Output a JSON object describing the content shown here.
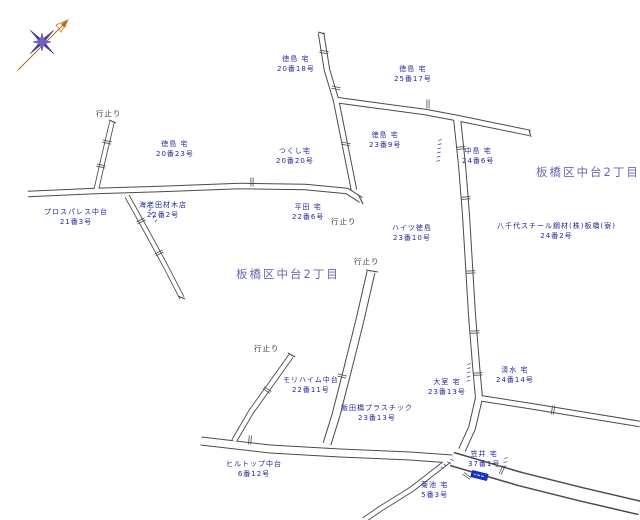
{
  "map": {
    "district_name": "板橋区中台2丁目",
    "colors": {
      "background": "#ffffff",
      "road_line": "#4a4a4a",
      "house_label": "#24249c",
      "area_label": "#6a6ab4",
      "deadend_label": "#3a3a3a",
      "sign_blue": "#1636c8",
      "compass_navy": "#3f3f9a",
      "compass_purple": "#7e5fc0",
      "compass_arrow": "#b5651d"
    },
    "labels": [
      {
        "type": "house",
        "x": 277,
        "y": 54,
        "lines": [
          "徳島 宅",
          "20番18号"
        ]
      },
      {
        "type": "house",
        "x": 394,
        "y": 64,
        "lines": [
          "徳島 宅",
          "25番17号"
        ]
      },
      {
        "type": "house",
        "x": 369,
        "y": 130,
        "lines": [
          "徳島 宅",
          "23番9号"
        ]
      },
      {
        "type": "house",
        "x": 462,
        "y": 146,
        "lines": [
          "中島 宅",
          "24番6号"
        ]
      },
      {
        "type": "dead",
        "x": 96,
        "y": 109,
        "lines": [
          "行止り"
        ]
      },
      {
        "type": "house",
        "x": 156,
        "y": 139,
        "lines": [
          "徳島 宅",
          "20番23号"
        ]
      },
      {
        "type": "house",
        "x": 276,
        "y": 146,
        "lines": [
          "つくし宅",
          "20番20号"
        ]
      },
      {
        "type": "area",
        "x": 536,
        "y": 167,
        "lines": [
          "板橋区中台2丁目"
        ]
      },
      {
        "type": "house",
        "x": 44,
        "y": 207,
        "lines": [
          "プロスパレス中台",
          "21番3号"
        ]
      },
      {
        "type": "house",
        "x": 139,
        "y": 200,
        "lines": [
          "海老田材木店",
          "22番2号"
        ]
      },
      {
        "type": "house",
        "x": 292,
        "y": 202,
        "lines": [
          "平田 宅",
          "22番6号"
        ]
      },
      {
        "type": "dead",
        "x": 331,
        "y": 217,
        "lines": [
          "行止り"
        ]
      },
      {
        "type": "house",
        "x": 392,
        "y": 223,
        "lines": [
          "ハイツ徳島",
          "23番10号"
        ]
      },
      {
        "type": "house",
        "x": 497,
        "y": 221,
        "lines": [
          "八千代スチール鋼材(株)板橋(寮)",
          "24番2号"
        ]
      },
      {
        "type": "area",
        "x": 236,
        "y": 269,
        "lines": [
          "板橋区中台2丁目"
        ]
      },
      {
        "type": "dead",
        "x": 354,
        "y": 257,
        "lines": [
          "行止り"
        ]
      },
      {
        "type": "dead",
        "x": 254,
        "y": 344,
        "lines": [
          "行止り"
        ]
      },
      {
        "type": "house",
        "x": 283,
        "y": 375,
        "lines": [
          "モリハイム中台",
          "22番11号"
        ]
      },
      {
        "type": "house",
        "x": 428,
        "y": 377,
        "lines": [
          "大室 宅",
          "23番13号"
        ]
      },
      {
        "type": "house",
        "x": 496,
        "y": 365,
        "lines": [
          "清水 宅",
          "24番14号"
        ]
      },
      {
        "type": "house",
        "x": 341,
        "y": 403,
        "lines": [
          "飯田橋プラスチック",
          "23番13号"
        ]
      },
      {
        "type": "house",
        "x": 226,
        "y": 459,
        "lines": [
          "ヒルトップ中台",
          "6番12号"
        ]
      },
      {
        "type": "house",
        "x": 468,
        "y": 449,
        "lines": [
          "笠井 宅",
          "37番1号"
        ]
      },
      {
        "type": "house",
        "x": 421,
        "y": 480,
        "lines": [
          "菊池 宅",
          "5番3号"
        ]
      }
    ],
    "roads": [
      {
        "id": "top-vertical",
        "d": "M321,33 L327,70 L336,100 L343,135 L350,170 L354,190",
        "w": 6.5,
        "f": 4.5
      },
      {
        "id": "top-east",
        "d": "M336,100 L380,106 L425,112 L457,118 L530,133",
        "w": 6.5,
        "f": 4.5
      },
      {
        "id": "right-vertical",
        "d": "M457,118 L462,165 L466,215 L469,265 L472,315 L476,365 L479,398 L472,428 L462,450",
        "w": 8,
        "f": 6
      },
      {
        "id": "mid-horizontal",
        "d": "M28,194 L95,191 L160,189 L240,186 L305,187 L347,191 L361,200",
        "w": 6.5,
        "f": 4.5
      },
      {
        "id": "deadend-upleft",
        "d": "M96,191 L103,160 L112,122",
        "w": 5.5,
        "f": 3.8
      },
      {
        "id": "branch-down-left",
        "d": "M127,196 L147,232 L166,267 L182,298",
        "w": 5.5,
        "f": 3.8
      },
      {
        "id": "center-deadend",
        "d": "M371,272 L360,320 L348,368 L336,415 L327,444",
        "w": 9,
        "f": 7
      },
      {
        "id": "left-deadend",
        "d": "M291,356 L271,384 L251,412 L234,441",
        "w": 6,
        "f": 4.2
      },
      {
        "id": "bottom-main",
        "d": "M201,441 L270,449 L340,453 L410,456 L452,459",
        "w": 9,
        "f": 7
      },
      {
        "id": "bottom-wide",
        "d": "M452,459 L520,479 L580,494 L640,508",
        "w": 15,
        "f": 12
      },
      {
        "id": "bottom-branch",
        "d": "M448,461 L412,489 L380,509 L364,520",
        "w": 6,
        "f": 4.2
      },
      {
        "id": "east-road",
        "d": "M479,398 L530,406 L585,415 L640,424",
        "w": 6.5,
        "f": 4.5
      }
    ],
    "caps": [
      [
        366,
        270,
        378,
        272
      ],
      [
        288,
        353,
        295,
        357
      ],
      [
        359,
        196,
        363,
        204
      ],
      [
        109,
        120,
        116,
        123
      ],
      [
        318,
        32,
        325,
        34
      ],
      [
        178,
        296,
        185,
        299
      ],
      [
        529,
        130,
        531,
        137
      ]
    ],
    "ticks": [
      [
        324,
        52,
        10
      ],
      [
        336,
        88,
        12
      ],
      [
        346,
        144,
        12
      ],
      [
        101,
        166,
        13
      ],
      [
        107,
        142,
        13
      ],
      [
        141,
        221,
        -28
      ],
      [
        159,
        253,
        -28
      ],
      [
        428,
        104,
        90
      ],
      [
        252,
        182,
        90
      ],
      [
        250,
        440,
        95
      ],
      [
        461,
        148,
        -5
      ],
      [
        466,
        198,
        -5
      ],
      [
        471,
        272,
        -3
      ],
      [
        475,
        332,
        -3
      ],
      [
        478,
        374,
        -3
      ],
      [
        267,
        390,
        34
      ],
      [
        342,
        376,
        14
      ],
      [
        553,
        410,
        99
      ],
      [
        502,
        470,
        115
      ],
      [
        467,
        476,
        35
      ]
    ],
    "squiggles": [
      {
        "x": 440,
        "y": 140,
        "rot": 95,
        "n": 6
      },
      {
        "x": 148,
        "y": 206,
        "rot": 62,
        "n": 5
      },
      {
        "x": 469,
        "y": 364,
        "rot": 92,
        "n": 5
      },
      {
        "x": 452,
        "y": 460,
        "rot": 142,
        "n": 4
      },
      {
        "x": 506,
        "y": 458,
        "rot": 100,
        "n": 3
      }
    ],
    "sign": {
      "x": 471,
      "y": 472,
      "name": "blue-road-sign"
    },
    "compass": {
      "name": "compass-rose",
      "direction": "north-east"
    }
  }
}
